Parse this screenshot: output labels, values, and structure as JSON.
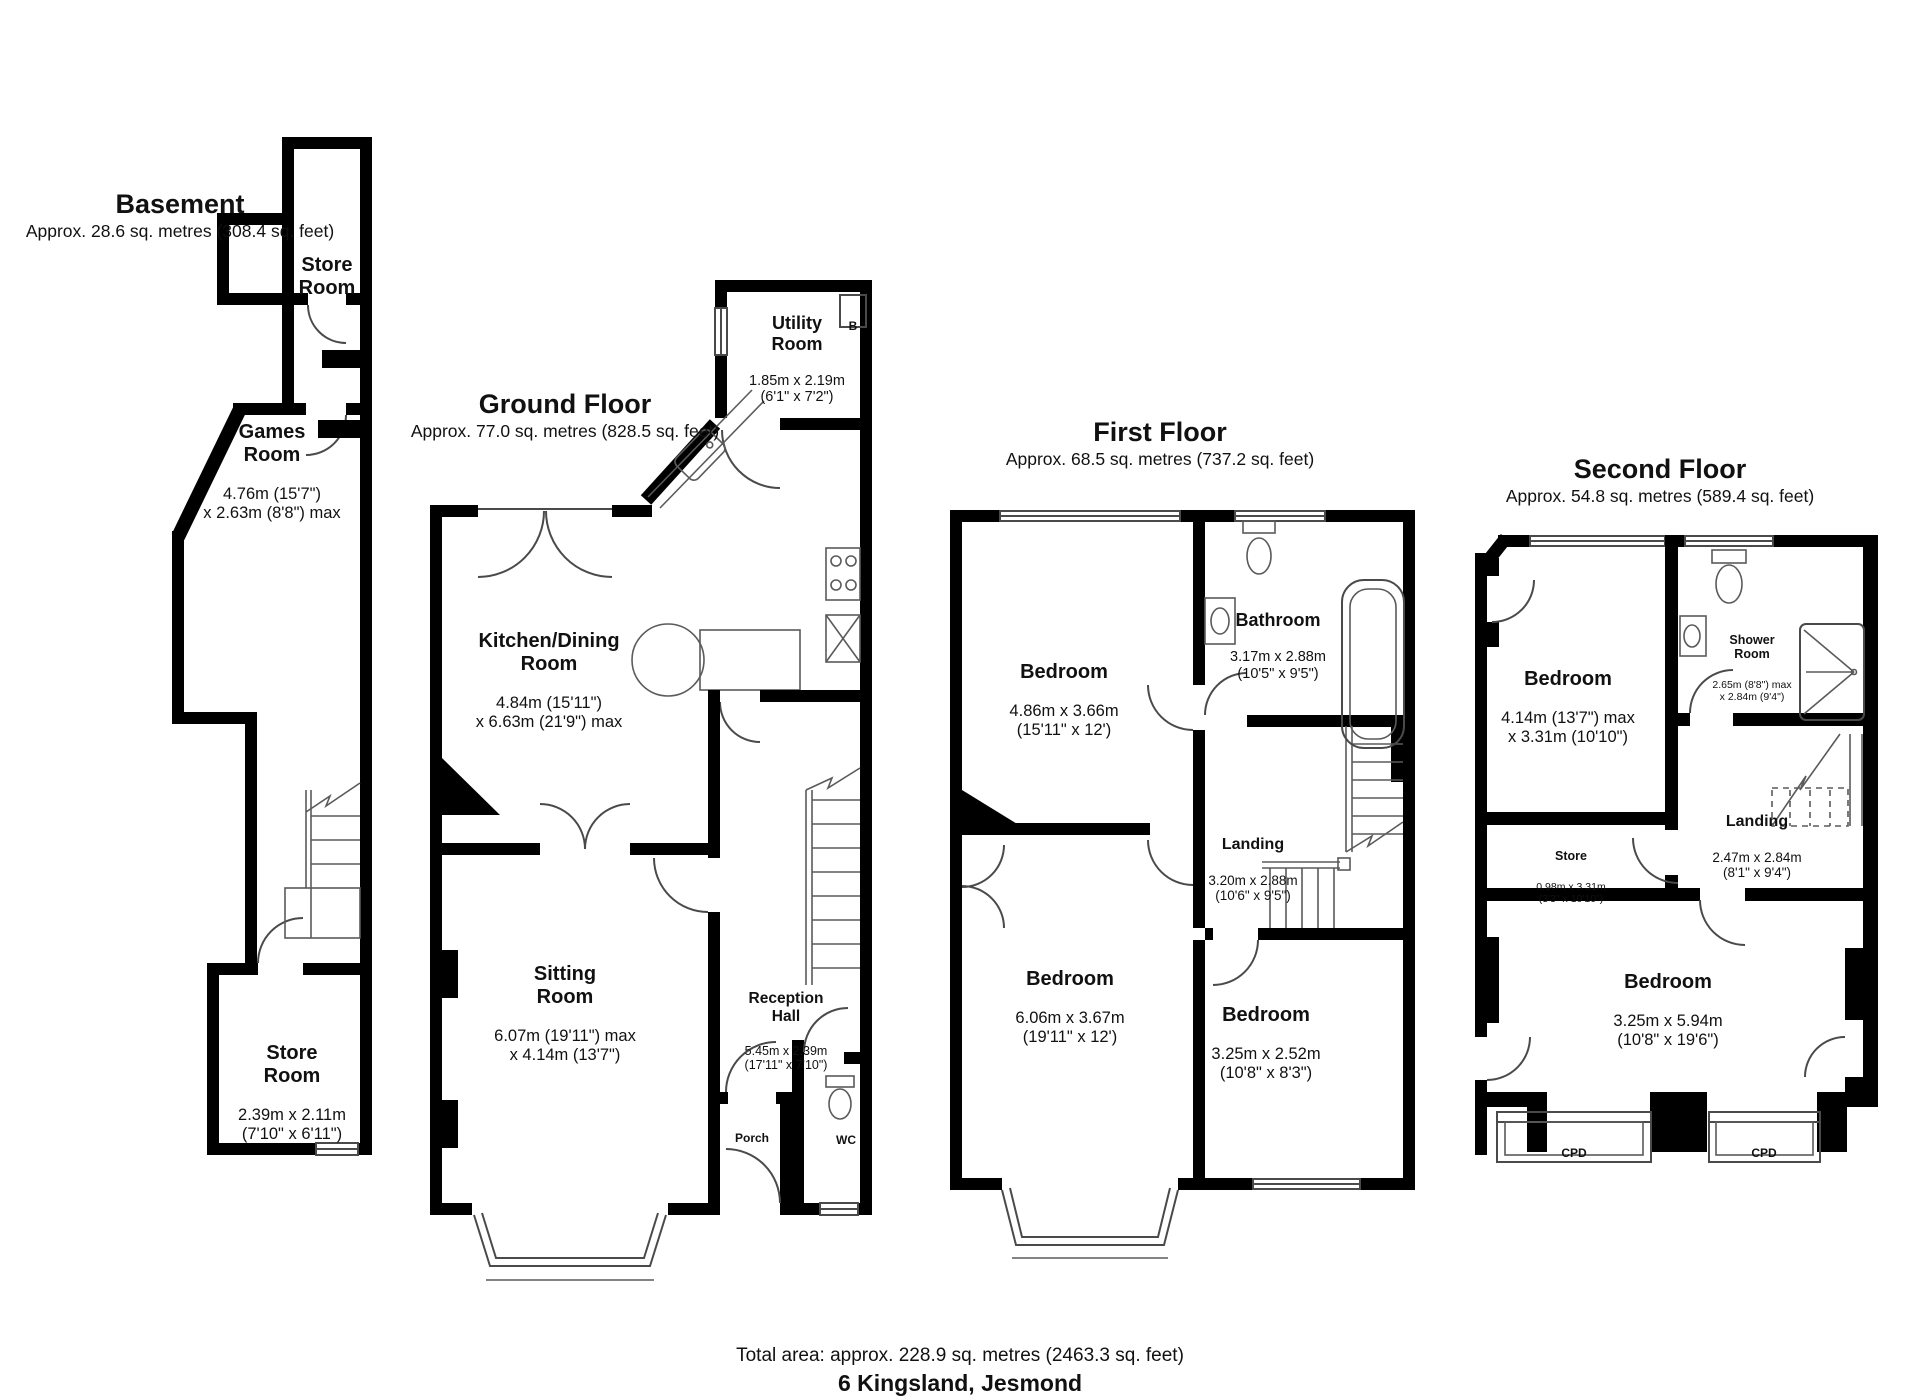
{
  "floors": {
    "basement": {
      "title": "Basement",
      "area": "Approx. 28.6 sq. metres (308.4 sq. feet)",
      "rooms": {
        "store_top": {
          "name": "Store\nRoom"
        },
        "games": {
          "name": "Games\nRoom",
          "dims": "4.76m (15'7\")\nx 2.63m (8'8\") max"
        },
        "store_bottom": {
          "name": "Store\nRoom",
          "dims": "2.39m x 2.11m\n(7'10\" x 6'11\")"
        }
      }
    },
    "ground": {
      "title": "Ground Floor",
      "area": "Approx. 77.0 sq. metres (828.5 sq. feet)",
      "rooms": {
        "utility": {
          "name": "Utility\nRoom",
          "dims": "1.85m x 2.19m\n(6'1\" x 7'2\")"
        },
        "boiler": {
          "name": "B"
        },
        "kitchen": {
          "name": "Kitchen/Dining\nRoom",
          "dims": "4.84m (15'11\")\nx 6.63m (21'9\") max"
        },
        "sitting": {
          "name": "Sitting\nRoom",
          "dims": "6.07m (19'11\") max\nx 4.14m (13'7\")"
        },
        "reception": {
          "name": "Reception\nHall",
          "dims": "5.45m x 2.39m\n(17'11\" x 7'10\")"
        },
        "porch": {
          "name": "Porch"
        },
        "wc": {
          "name": "WC"
        }
      }
    },
    "first": {
      "title": "First Floor",
      "area": "Approx. 68.5 sq. metres (737.2 sq. feet)",
      "rooms": {
        "bedroom1": {
          "name": "Bedroom",
          "dims": "4.86m x 3.66m\n(15'11\" x 12')"
        },
        "bathroom": {
          "name": "Bathroom",
          "dims": "3.17m x 2.88m\n(10'5\" x 9'5\")"
        },
        "landing": {
          "name": "Landing",
          "dims": "3.20m x 2.88m\n(10'6\" x 9'5\")"
        },
        "bedroom2": {
          "name": "Bedroom",
          "dims": "6.06m x 3.67m\n(19'11\" x 12')"
        },
        "bedroom3": {
          "name": "Bedroom",
          "dims": "3.25m x 2.52m\n(10'8\" x 8'3\")"
        }
      }
    },
    "second": {
      "title": "Second Floor",
      "area": "Approx. 54.8 sq. metres (589.4 sq. feet)",
      "rooms": {
        "bedroom4": {
          "name": "Bedroom",
          "dims": "4.14m (13'7\") max\nx 3.31m (10'10\")"
        },
        "shower": {
          "name": "Shower\nRoom",
          "dims": "2.65m (8'8\") max\nx 2.84m (9'4\")"
        },
        "store": {
          "name": "Store",
          "dims": "0.98m x 3.31m\n(3'3\" x 10'10\")"
        },
        "landing": {
          "name": "Landing",
          "dims": "2.47m x 2.84m\n(8'1\" x 9'4\")"
        },
        "bedroom5": {
          "name": "Bedroom",
          "dims": "3.25m x 5.94m\n(10'8\" x 19'6\")"
        },
        "cpd1": {
          "name": "CPD"
        },
        "cpd2": {
          "name": "CPD"
        }
      }
    }
  },
  "footer": {
    "total_area": "Total area: approx. 228.9 sq. metres (2463.3 sq. feet)",
    "address": "6 Kingsland, Jesmond"
  },
  "colors": {
    "wall": "#000000",
    "thin_line": "#4a4a4a",
    "text": "#111111",
    "background": "#ffffff"
  }
}
